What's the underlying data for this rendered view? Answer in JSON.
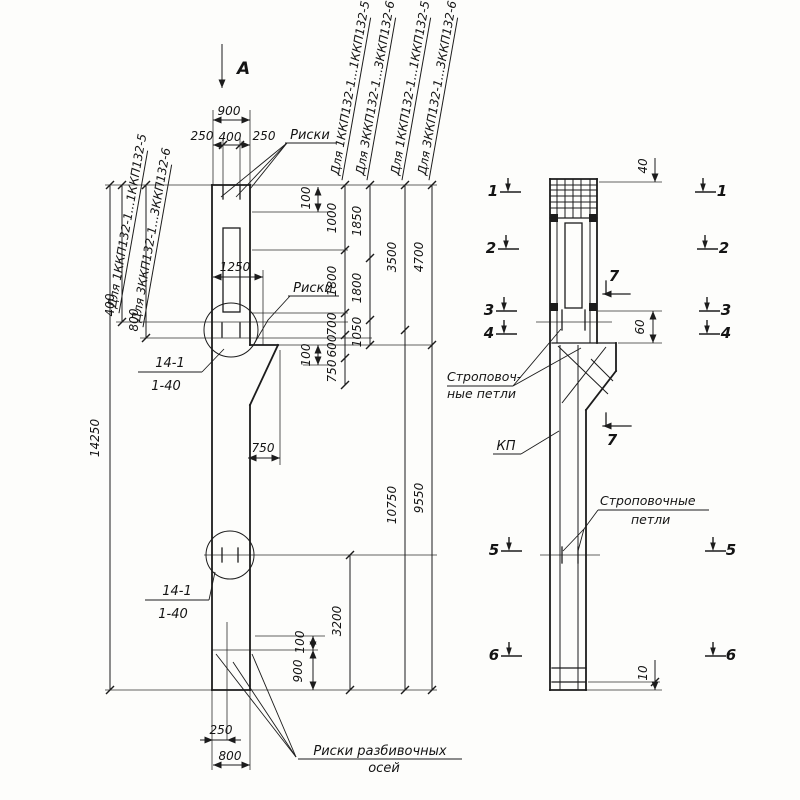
{
  "colors": {
    "ink": "#1c1c1c",
    "paper": "#fdfdfb"
  },
  "dims": {
    "d14250": "14250",
    "d900": "900",
    "d250": "250",
    "d400": "400",
    "d100": "100",
    "d1000": "1000",
    "d1850": "1850",
    "d1800": "1800",
    "d3500": "3500",
    "d4700": "4700",
    "d1250": "1250",
    "d700": "700",
    "d1050": "1050",
    "d600": "600",
    "d750": "750",
    "d10750": "10750",
    "d9550": "9550",
    "d3200": "3200",
    "d800": "800",
    "d40": "40",
    "d60": "60",
    "d10": "10"
  },
  "labels": {
    "view_arrow": "А",
    "riski": "Риски",
    "riski_axes_line1": "Риски разбивочных",
    "riski_axes_line2": "осей",
    "detail_ref": "14-1",
    "detail_sheet": "1-40",
    "sling1_line1": "Строповоч-",
    "sling1_line2": "ные петли",
    "sling2_line1": "Строповочные",
    "sling2_line2": "петли",
    "kp": "КП",
    "type1": "Для 1ККП132-1...1ККП132-5",
    "type3": "Для 3ККП132-1...3ККП132-6"
  },
  "sections": {
    "s1": "1",
    "s2": "2",
    "s3": "3",
    "s4": "4",
    "s5": "5",
    "s6": "6",
    "s7": "7"
  }
}
